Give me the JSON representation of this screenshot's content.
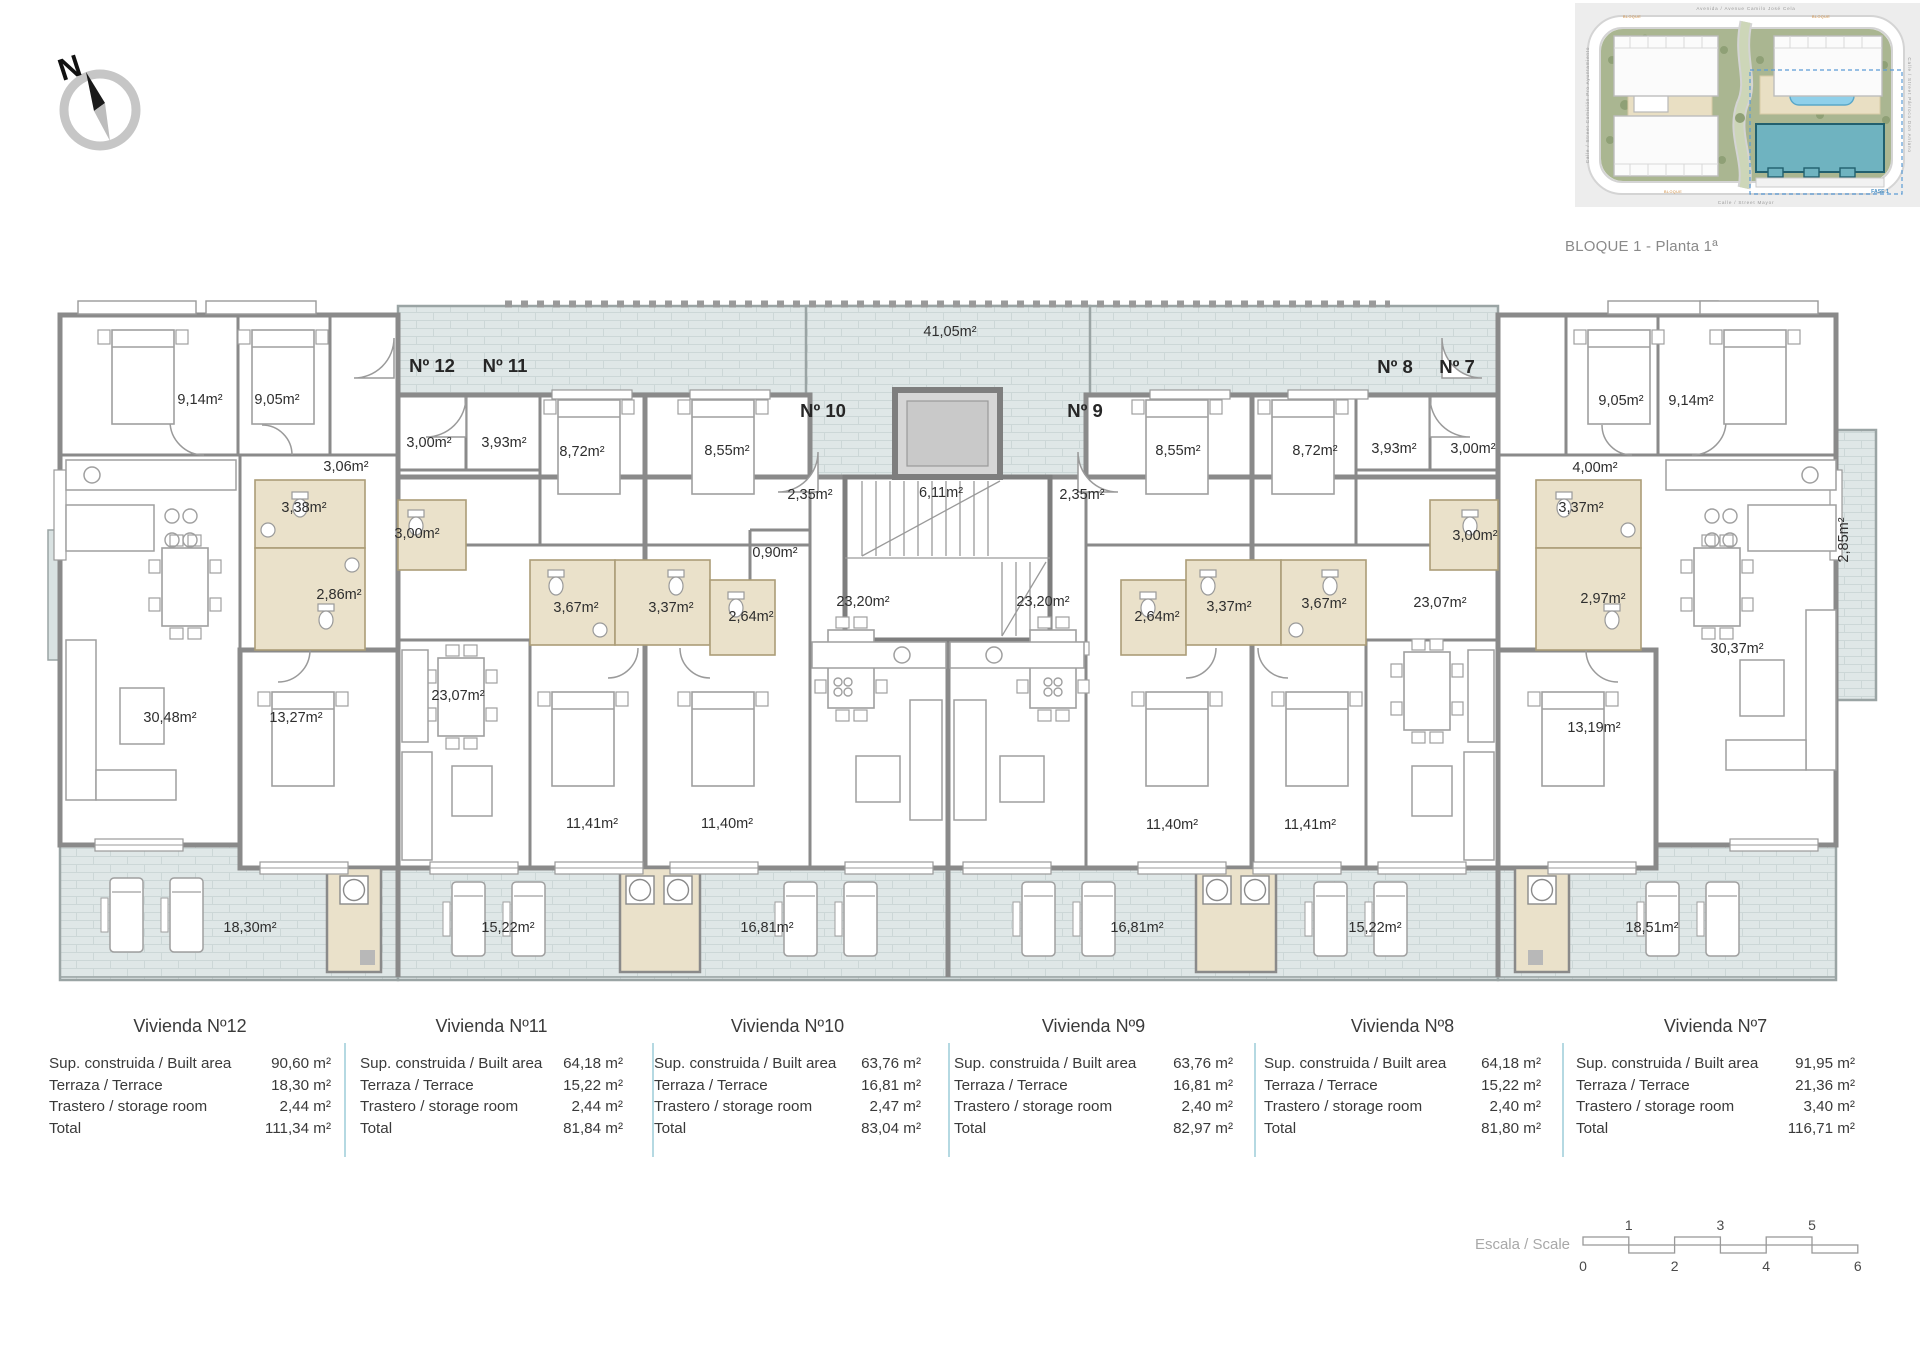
{
  "compass": {
    "north_label": "N"
  },
  "site_plan": {
    "caption": "BLOQUE 1 - Planta 1ª",
    "streets": {
      "top": "Avenida / Avenue Camilo José Cela",
      "bottom": "Calle / Street Mayor",
      "left": "Calle / Street Comisión Pro Ayuntamiento",
      "right": "Calle / Street Párroco Don Aniano"
    },
    "block_labels": [
      "BLOQUE",
      "BLOQUE",
      "BLOQUE"
    ],
    "phase_label": "FASE 1"
  },
  "floor_plan": {
    "apartment_labels": [
      {
        "t": "Nº 12",
        "x": 432,
        "y": 372
      },
      {
        "t": "Nº 11",
        "x": 505,
        "y": 372
      },
      {
        "t": "Nº 10",
        "x": 823,
        "y": 417
      },
      {
        "t": "Nº 9",
        "x": 1085,
        "y": 417
      },
      {
        "t": "Nº 8",
        "x": 1395,
        "y": 373
      },
      {
        "t": "Nº 7",
        "x": 1457,
        "y": 373
      }
    ],
    "area_labels": [
      {
        "t": "41,05m²",
        "x": 950,
        "y": 336
      },
      {
        "t": "9,14m²",
        "x": 200,
        "y": 404
      },
      {
        "t": "9,05m²",
        "x": 277,
        "y": 404
      },
      {
        "t": "3,00m²",
        "x": 429,
        "y": 447
      },
      {
        "t": "3,93m²",
        "x": 504,
        "y": 447
      },
      {
        "t": "3,06m²",
        "x": 346,
        "y": 471
      },
      {
        "t": "8,72m²",
        "x": 582,
        "y": 456
      },
      {
        "t": "8,55m²",
        "x": 727,
        "y": 455
      },
      {
        "t": "2,35m²",
        "x": 810,
        "y": 499
      },
      {
        "t": "6,11m²",
        "x": 941,
        "y": 497
      },
      {
        "t": "2,35m²",
        "x": 1082,
        "y": 499
      },
      {
        "t": "8,55m²",
        "x": 1178,
        "y": 455
      },
      {
        "t": "8,72m²",
        "x": 1315,
        "y": 455
      },
      {
        "t": "3,93m²",
        "x": 1394,
        "y": 453
      },
      {
        "t": "3,00m²",
        "x": 1473,
        "y": 453
      },
      {
        "t": "9,05m²",
        "x": 1621,
        "y": 405
      },
      {
        "t": "9,14m²",
        "x": 1691,
        "y": 405
      },
      {
        "t": "4,00m²",
        "x": 1595,
        "y": 472
      },
      {
        "t": "3,38m²",
        "x": 304,
        "y": 512
      },
      {
        "t": "3,00m²",
        "x": 417,
        "y": 538
      },
      {
        "t": "0,90m²",
        "x": 775,
        "y": 557
      },
      {
        "t": "3,00m²",
        "x": 1475,
        "y": 540
      },
      {
        "t": "3,37m²",
        "x": 1581,
        "y": 512
      },
      {
        "t": "2,86m²",
        "x": 339,
        "y": 599
      },
      {
        "t": "2,97m²",
        "x": 1603,
        "y": 603
      },
      {
        "t": "3,67m²",
        "x": 576,
        "y": 612
      },
      {
        "t": "3,37m²",
        "x": 671,
        "y": 612
      },
      {
        "t": "2,64m²",
        "x": 751,
        "y": 621
      },
      {
        "t": "23,20m²",
        "x": 863,
        "y": 606
      },
      {
        "t": "23,20m²",
        "x": 1043,
        "y": 606
      },
      {
        "t": "2,64m²",
        "x": 1157,
        "y": 621
      },
      {
        "t": "3,37m²",
        "x": 1229,
        "y": 611
      },
      {
        "t": "3,67m²",
        "x": 1324,
        "y": 608
      },
      {
        "t": "23,07m²",
        "x": 458,
        "y": 700
      },
      {
        "t": "23,07m²",
        "x": 1440,
        "y": 607
      },
      {
        "t": "30,48m²",
        "x": 170,
        "y": 722
      },
      {
        "t": "13,27m²",
        "x": 296,
        "y": 722
      },
      {
        "t": "30,37m²",
        "x": 1737,
        "y": 653
      },
      {
        "t": "13,19m²",
        "x": 1594,
        "y": 732
      },
      {
        "t": "11,41m²",
        "x": 592,
        "y": 828
      },
      {
        "t": "11,40m²",
        "x": 727,
        "y": 828
      },
      {
        "t": "11,40m²",
        "x": 1172,
        "y": 829
      },
      {
        "t": "11,41m²",
        "x": 1310,
        "y": 829
      },
      {
        "t": "18,30m²",
        "x": 250,
        "y": 932
      },
      {
        "t": "15,22m²",
        "x": 508,
        "y": 932
      },
      {
        "t": "16,81m²",
        "x": 767,
        "y": 932
      },
      {
        "t": "16,81m²",
        "x": 1137,
        "y": 932
      },
      {
        "t": "15,22m²",
        "x": 1375,
        "y": 932
      },
      {
        "t": "18,51m²",
        "x": 1652,
        "y": 932
      }
    ],
    "vertical_labels": [
      {
        "t": "2,85m²",
        "x": 1848,
        "y": 540
      }
    ]
  },
  "summary_tables": {
    "row_labels": [
      "Sup. construida / Built area",
      "Terraza / Terrace",
      "Trastero / storage room",
      "Total"
    ],
    "units": [
      {
        "title": "Vivienda Nº12",
        "values": [
          "90,60 m²",
          "18,30 m²",
          "2,44 m²",
          "111,34 m²"
        ]
      },
      {
        "title": "Vivienda Nº11",
        "values": [
          "64,18 m²",
          "15,22 m²",
          "2,44 m²",
          "81,84 m²"
        ]
      },
      {
        "title": "Vivienda Nº10",
        "values": [
          "63,76 m²",
          "16,81 m²",
          "2,47 m²",
          "83,04 m²"
        ]
      },
      {
        "title": "Vivienda Nº9",
        "values": [
          "63,76 m²",
          "16,81 m²",
          "2,40 m²",
          "82,97 m²"
        ]
      },
      {
        "title": "Vivienda Nº8",
        "values": [
          "64,18 m²",
          "15,22 m²",
          "2,40 m²",
          "81,80 m²"
        ]
      },
      {
        "title": "Vivienda Nº7",
        "values": [
          "91,95 m²",
          "21,36 m²",
          "3,40 m²",
          "116,71 m²"
        ]
      }
    ]
  },
  "scale_bar": {
    "label": "Escala / Scale",
    "top_numbers": [
      "1",
      "3",
      "5"
    ],
    "bottom_numbers": [
      "0",
      "2",
      "4",
      "6"
    ]
  }
}
